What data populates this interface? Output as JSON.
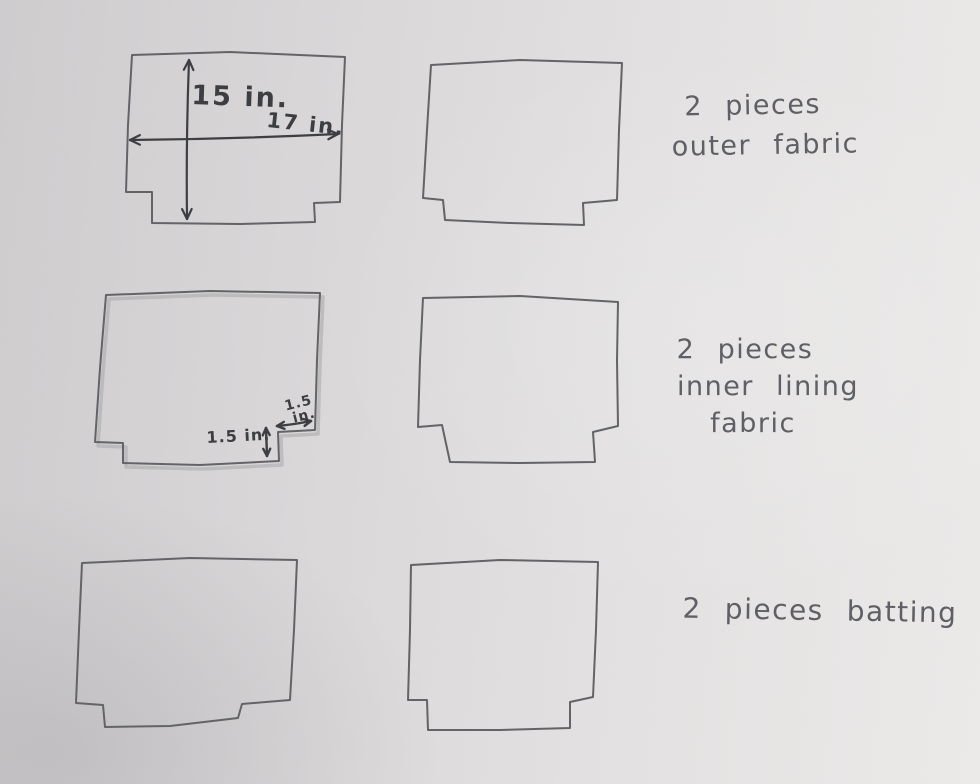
{
  "sketch": {
    "paper": {
      "bg_left": "#cfcdce",
      "bg_right": "#ecebea",
      "pencil_color": "#636468",
      "marker_color": "#3e3f43",
      "note_color": "#5f6065",
      "shadow_color": "#a8a7a9"
    },
    "pieces": [
      {
        "name": "outer-fabric-piece-1",
        "shadow": false,
        "points": [
          [
            132,
            55
          ],
          [
            230,
            52
          ],
          [
            345,
            57
          ],
          [
            342,
            125
          ],
          [
            340,
            202
          ],
          [
            314,
            203
          ],
          [
            315,
            222
          ],
          [
            240,
            224
          ],
          [
            152,
            223
          ],
          [
            152,
            192
          ],
          [
            126,
            192
          ],
          [
            128,
            125
          ]
        ]
      },
      {
        "name": "outer-fabric-piece-2",
        "shadow": false,
        "points": [
          [
            431,
            65
          ],
          [
            520,
            60
          ],
          [
            622,
            63
          ],
          [
            619,
            130
          ],
          [
            617,
            200
          ],
          [
            583,
            203
          ],
          [
            584,
            225
          ],
          [
            510,
            223
          ],
          [
            445,
            220
          ],
          [
            443,
            200
          ],
          [
            423,
            198
          ],
          [
            427,
            130
          ]
        ]
      },
      {
        "name": "inner-lining-piece-1",
        "shadow": true,
        "points": [
          [
            106,
            295
          ],
          [
            210,
            291
          ],
          [
            320,
            293
          ],
          [
            317,
            360
          ],
          [
            315,
            430
          ],
          [
            278,
            432
          ],
          [
            279,
            461
          ],
          [
            200,
            465
          ],
          [
            123,
            463
          ],
          [
            123,
            443
          ],
          [
            95,
            442
          ],
          [
            100,
            368
          ]
        ]
      },
      {
        "name": "inner-lining-piece-2",
        "shadow": false,
        "points": [
          [
            423,
            298
          ],
          [
            520,
            296
          ],
          [
            618,
            302
          ],
          [
            617,
            360
          ],
          [
            618,
            426
          ],
          [
            593,
            432
          ],
          [
            595,
            462
          ],
          [
            520,
            463
          ],
          [
            450,
            462
          ],
          [
            442,
            425
          ],
          [
            418,
            427
          ],
          [
            420,
            360
          ]
        ]
      },
      {
        "name": "batting-piece-1",
        "shadow": false,
        "points": [
          [
            82,
            563
          ],
          [
            190,
            558
          ],
          [
            297,
            560
          ],
          [
            294,
            630
          ],
          [
            290,
            700
          ],
          [
            242,
            704
          ],
          [
            238,
            718
          ],
          [
            170,
            726
          ],
          [
            105,
            727
          ],
          [
            103,
            705
          ],
          [
            76,
            703
          ],
          [
            79,
            630
          ]
        ]
      },
      {
        "name": "batting-piece-2",
        "shadow": false,
        "points": [
          [
            411,
            565
          ],
          [
            500,
            560
          ],
          [
            598,
            562
          ],
          [
            596,
            630
          ],
          [
            593,
            697
          ],
          [
            570,
            702
          ],
          [
            570,
            728
          ],
          [
            500,
            730
          ],
          [
            428,
            730
          ],
          [
            427,
            700
          ],
          [
            408,
            700
          ],
          [
            410,
            630
          ]
        ]
      }
    ],
    "arrows": [
      {
        "name": "height-dimension-arrow",
        "x1": 189,
        "y1": 60,
        "x2": 187,
        "y2": 219,
        "bend": 2,
        "width": 2.2,
        "head": 11
      },
      {
        "name": "width-dimension-arrow",
        "x1": 130,
        "y1": 140,
        "x2": 338,
        "y2": 134,
        "bend": 2,
        "width": 2.2,
        "head": 11
      },
      {
        "name": "notch-height-arrow",
        "x1": 266,
        "y1": 428,
        "x2": 267,
        "y2": 456,
        "bend": 0,
        "width": 2.4,
        "head": 8
      },
      {
        "name": "notch-width-arrow",
        "x1": 277,
        "y1": 426,
        "x2": 311,
        "y2": 421,
        "bend": 1,
        "width": 2.4,
        "head": 8
      }
    ],
    "dimension_labels": [
      {
        "text": "15 in."
      },
      {
        "text": "17 in."
      },
      {
        "text": "1.5 in."
      },
      {
        "text": "1.5"
      },
      {
        "text": "in."
      }
    ],
    "notes": [
      {
        "lines": [
          "2 pieces",
          "outer fabric"
        ]
      },
      {
        "lines": [
          "2 pieces",
          "inner lining",
          "fabric"
        ]
      },
      {
        "lines": [
          "2 pieces batting"
        ]
      }
    ]
  }
}
